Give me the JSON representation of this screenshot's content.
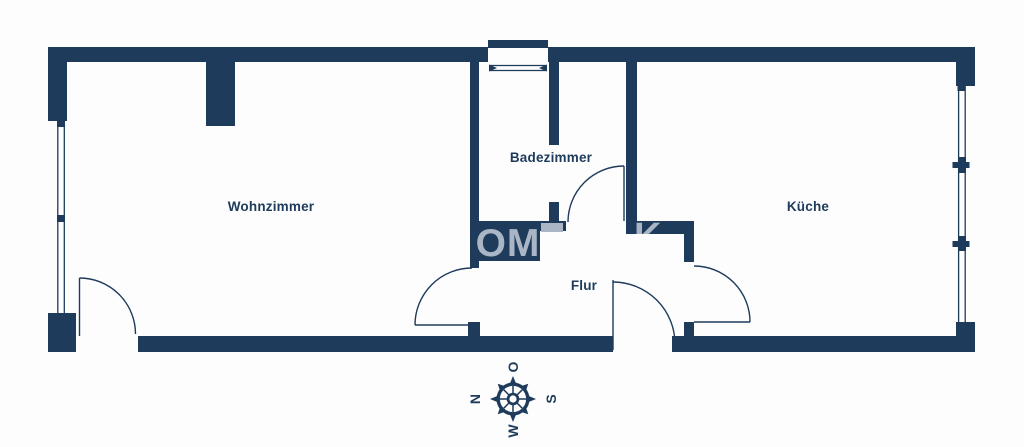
{
  "plan": {
    "rooms": [
      {
        "key": "wohnzimmer",
        "label": "Wohnzimmer"
      },
      {
        "key": "badezimmer",
        "label": "Badezimmer"
      },
      {
        "key": "kueche",
        "label": "Küche"
      },
      {
        "key": "flur",
        "label": "Flur"
      }
    ],
    "compass": {
      "north": "N",
      "east": "O",
      "south": "S",
      "west": "W",
      "orientation_note": "north-points-left"
    },
    "watermark": {
      "fragment_left": "OM",
      "fragment_right": "K"
    },
    "colors": {
      "wall": "#1e3b5c",
      "background": "#fdfdfd",
      "watermark": "#aab6c5"
    }
  }
}
